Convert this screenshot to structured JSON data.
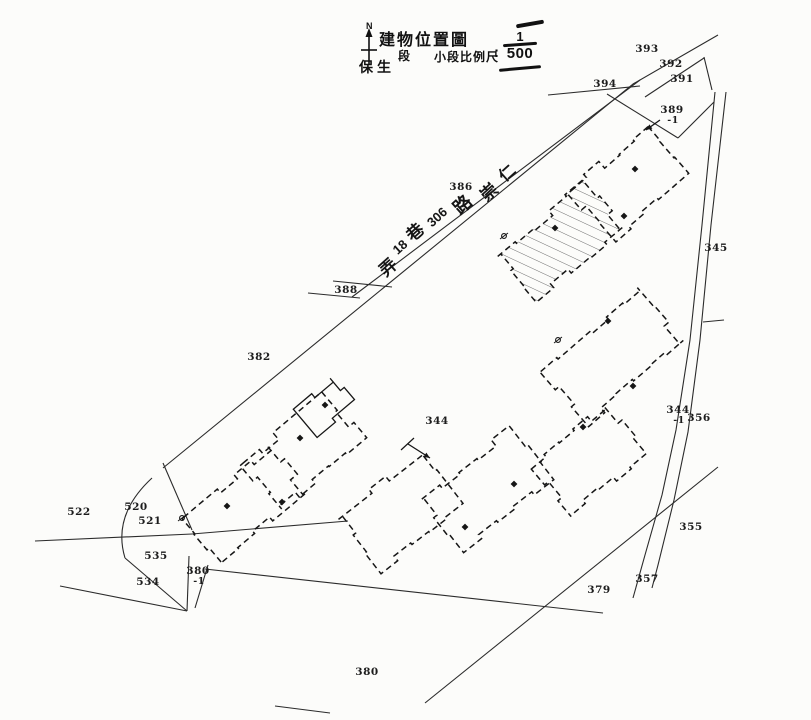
{
  "colors": {
    "ink": "#2b2b2b",
    "building_ink": "#161616",
    "hatch": "#6e6e6e",
    "paper": "#fcfcfa"
  },
  "title_block": {
    "north_label": "N",
    "title": "建物位置圖",
    "section_prefix": "保生",
    "section_suffix": "段",
    "scale_label": "小段比例尺",
    "scale_colon": ":",
    "scale_numerator": "1",
    "scale_denominator": "500"
  },
  "road": {
    "name": "崇仁路306巷18弄",
    "chars": [
      {
        "t": "弄",
        "x": 387,
        "y": 266,
        "size": 17
      },
      {
        "t": "18",
        "x": 400,
        "y": 247,
        "size": 13
      },
      {
        "t": "巷",
        "x": 414,
        "y": 231,
        "size": 17
      },
      {
        "t": "306",
        "x": 437,
        "y": 217,
        "size": 13
      },
      {
        "t": "路",
        "x": 462,
        "y": 204,
        "size": 18
      },
      {
        "t": "崇",
        "x": 488,
        "y": 191,
        "size": 17
      },
      {
        "t": "仁",
        "x": 506,
        "y": 172,
        "size": 16
      }
    ]
  },
  "parcel_labels": [
    {
      "label": "393",
      "x": 647,
      "y": 50
    },
    {
      "label": "392",
      "x": 671,
      "y": 65
    },
    {
      "label": "391",
      "x": 682,
      "y": 80
    },
    {
      "label": "394",
      "x": 605,
      "y": 85
    },
    {
      "label": "389",
      "sub": "-1",
      "x": 672,
      "y": 116
    },
    {
      "label": "386",
      "x": 461,
      "y": 188
    },
    {
      "label": "345",
      "x": 716,
      "y": 249
    },
    {
      "label": "388",
      "x": 346,
      "y": 291
    },
    {
      "label": "382",
      "x": 259,
      "y": 358
    },
    {
      "label": "344",
      "x": 437,
      "y": 422
    },
    {
      "label": "344",
      "sub": "-1",
      "x": 678,
      "y": 416
    },
    {
      "label": "356",
      "x": 699,
      "y": 419
    },
    {
      "label": "355",
      "x": 691,
      "y": 528
    },
    {
      "label": "357",
      "x": 647,
      "y": 580
    },
    {
      "label": "379",
      "x": 599,
      "y": 591
    },
    {
      "label": "380",
      "x": 367,
      "y": 673
    },
    {
      "label": "522",
      "x": 79,
      "y": 513
    },
    {
      "label": "520",
      "x": 136,
      "y": 508
    },
    {
      "label": "521",
      "x": 150,
      "y": 522
    },
    {
      "label": "535",
      "x": 156,
      "y": 557
    },
    {
      "label": "534",
      "x": 148,
      "y": 583
    },
    {
      "label": "380",
      "sub": "-1",
      "x": 198,
      "y": 577
    }
  ],
  "map": {
    "lines": [
      {
        "name": "nw-boundary",
        "pts": [
          [
            718,
            35
          ],
          [
            633,
            84
          ],
          [
            163,
            468
          ]
        ]
      },
      {
        "name": "road-upper-edge",
        "pts": [
          [
            640,
            80
          ],
          [
            352,
            297
          ]
        ]
      },
      {
        "name": "tick-388-a",
        "pts": [
          [
            333,
            281
          ],
          [
            392,
            287
          ]
        ]
      },
      {
        "name": "tick-388-b",
        "pts": [
          [
            308,
            293
          ],
          [
            360,
            298
          ]
        ]
      },
      {
        "name": "line-394",
        "pts": [
          [
            548,
            95
          ],
          [
            640,
            86
          ]
        ]
      },
      {
        "name": "line-391",
        "pts": [
          [
            645,
            97
          ],
          [
            704,
            58
          ]
        ]
      },
      {
        "name": "line-right-conn",
        "pts": [
          [
            704,
            57
          ],
          [
            712,
            90
          ]
        ]
      },
      {
        "name": "line-389-sw",
        "pts": [
          [
            607,
            94
          ],
          [
            678,
            138
          ]
        ]
      },
      {
        "name": "line-389-se",
        "pts": [
          [
            714,
            102
          ],
          [
            678,
            138
          ]
        ]
      },
      {
        "name": "east-road-left",
        "pts": [
          [
            715,
            92
          ],
          [
            702,
            225
          ],
          [
            690,
            340
          ],
          [
            676,
            430
          ],
          [
            662,
            495
          ],
          [
            645,
            555
          ],
          [
            633,
            598
          ]
        ]
      },
      {
        "name": "east-road-right",
        "pts": [
          [
            726,
            92
          ],
          [
            711,
            225
          ],
          [
            700,
            340
          ],
          [
            688,
            432
          ],
          [
            674,
            500
          ],
          [
            658,
            565
          ],
          [
            652,
            588
          ]
        ]
      },
      {
        "name": "road-tick",
        "pts": [
          [
            703,
            322
          ],
          [
            724,
            320
          ]
        ]
      },
      {
        "name": "se-diagonal",
        "pts": [
          [
            718,
            467
          ],
          [
            425,
            703
          ]
        ]
      },
      {
        "name": "south-boundary",
        "pts": [
          [
            205,
            569
          ],
          [
            603,
            613
          ]
        ]
      },
      {
        "name": "west-hline",
        "pts": [
          [
            35,
            541
          ],
          [
            192,
            534
          ]
        ]
      },
      {
        "name": "divider-520",
        "pts": [
          [
            163,
            463
          ],
          [
            192,
            530
          ]
        ]
      },
      {
        "name": "line-521",
        "pts": [
          [
            192,
            534
          ],
          [
            348,
            521
          ]
        ]
      },
      {
        "name": "line-534-upper",
        "pts": [
          [
            125,
            558
          ],
          [
            187,
            611
          ]
        ]
      },
      {
        "name": "line-534-lower",
        "pts": [
          [
            60,
            586
          ],
          [
            187,
            611
          ]
        ]
      },
      {
        "name": "sub380-west",
        "pts": [
          [
            189,
            556
          ],
          [
            187,
            611
          ]
        ]
      },
      {
        "name": "sub380-east",
        "pts": [
          [
            208,
            565
          ],
          [
            195,
            608
          ]
        ]
      },
      {
        "name": "stray-south",
        "pts": [
          [
            275,
            706
          ],
          [
            330,
            713
          ]
        ]
      }
    ],
    "curves": [
      {
        "name": "west-corner-arc",
        "d": "M152,478 Q112,515 125,558"
      }
    ],
    "buildings": [
      {
        "name": "building-subject-hatched",
        "cx": 560,
        "cy": 242,
        "len": 114,
        "wid": 58,
        "ang": -40,
        "seed": 11,
        "hatched": true
      },
      {
        "name": "building-a2",
        "cx": 630,
        "cy": 182,
        "len": 100,
        "wid": 64,
        "ang": -41,
        "seed": 23
      },
      {
        "name": "building-upper-mid",
        "cx": 612,
        "cy": 356,
        "len": 128,
        "wid": 70,
        "ang": -41,
        "seed": 37
      },
      {
        "name": "building-mid-right",
        "cx": 588,
        "cy": 462,
        "len": 96,
        "wid": 62,
        "ang": -40,
        "seed": 51
      },
      {
        "name": "building-mid-center",
        "cx": 487,
        "cy": 490,
        "len": 114,
        "wid": 66,
        "ang": -38,
        "seed": 67
      },
      {
        "name": "building-mid-left",
        "cx": 400,
        "cy": 512,
        "len": 106,
        "wid": 64,
        "ang": -38,
        "seed": 83
      },
      {
        "name": "building-left-upper",
        "cx": 303,
        "cy": 452,
        "len": 106,
        "wid": 60,
        "ang": -40,
        "seed": 95
      },
      {
        "name": "building-left-lower",
        "cx": 245,
        "cy": 505,
        "len": 110,
        "wid": 60,
        "ang": -40,
        "seed": 108
      },
      {
        "name": "building-annex",
        "cx": 322,
        "cy": 406,
        "len": 48,
        "wid": 32,
        "ang": -40,
        "seed": 120,
        "solid": true
      }
    ],
    "survey_marks": [
      [
        635,
        169
      ],
      [
        624,
        216
      ],
      [
        555,
        228
      ],
      [
        608,
        321
      ],
      [
        633,
        386
      ],
      [
        583,
        427
      ],
      [
        514,
        484
      ],
      [
        465,
        527
      ],
      [
        300,
        438
      ],
      [
        227,
        506
      ],
      [
        282,
        502
      ],
      [
        325,
        405
      ]
    ],
    "benchmarks": [
      [
        504,
        236
      ],
      [
        182,
        518
      ],
      [
        558,
        340
      ]
    ],
    "arrows": [
      {
        "name": "arrow-389",
        "from": [
          660,
          120
        ],
        "to": [
          646,
          130
        ]
      },
      {
        "name": "arrow-344",
        "from": [
          408,
          444
        ],
        "to": [
          430,
          458
        ],
        "bar": [
          [
            401,
            450
          ],
          [
            414,
            438
          ]
        ]
      }
    ]
  }
}
